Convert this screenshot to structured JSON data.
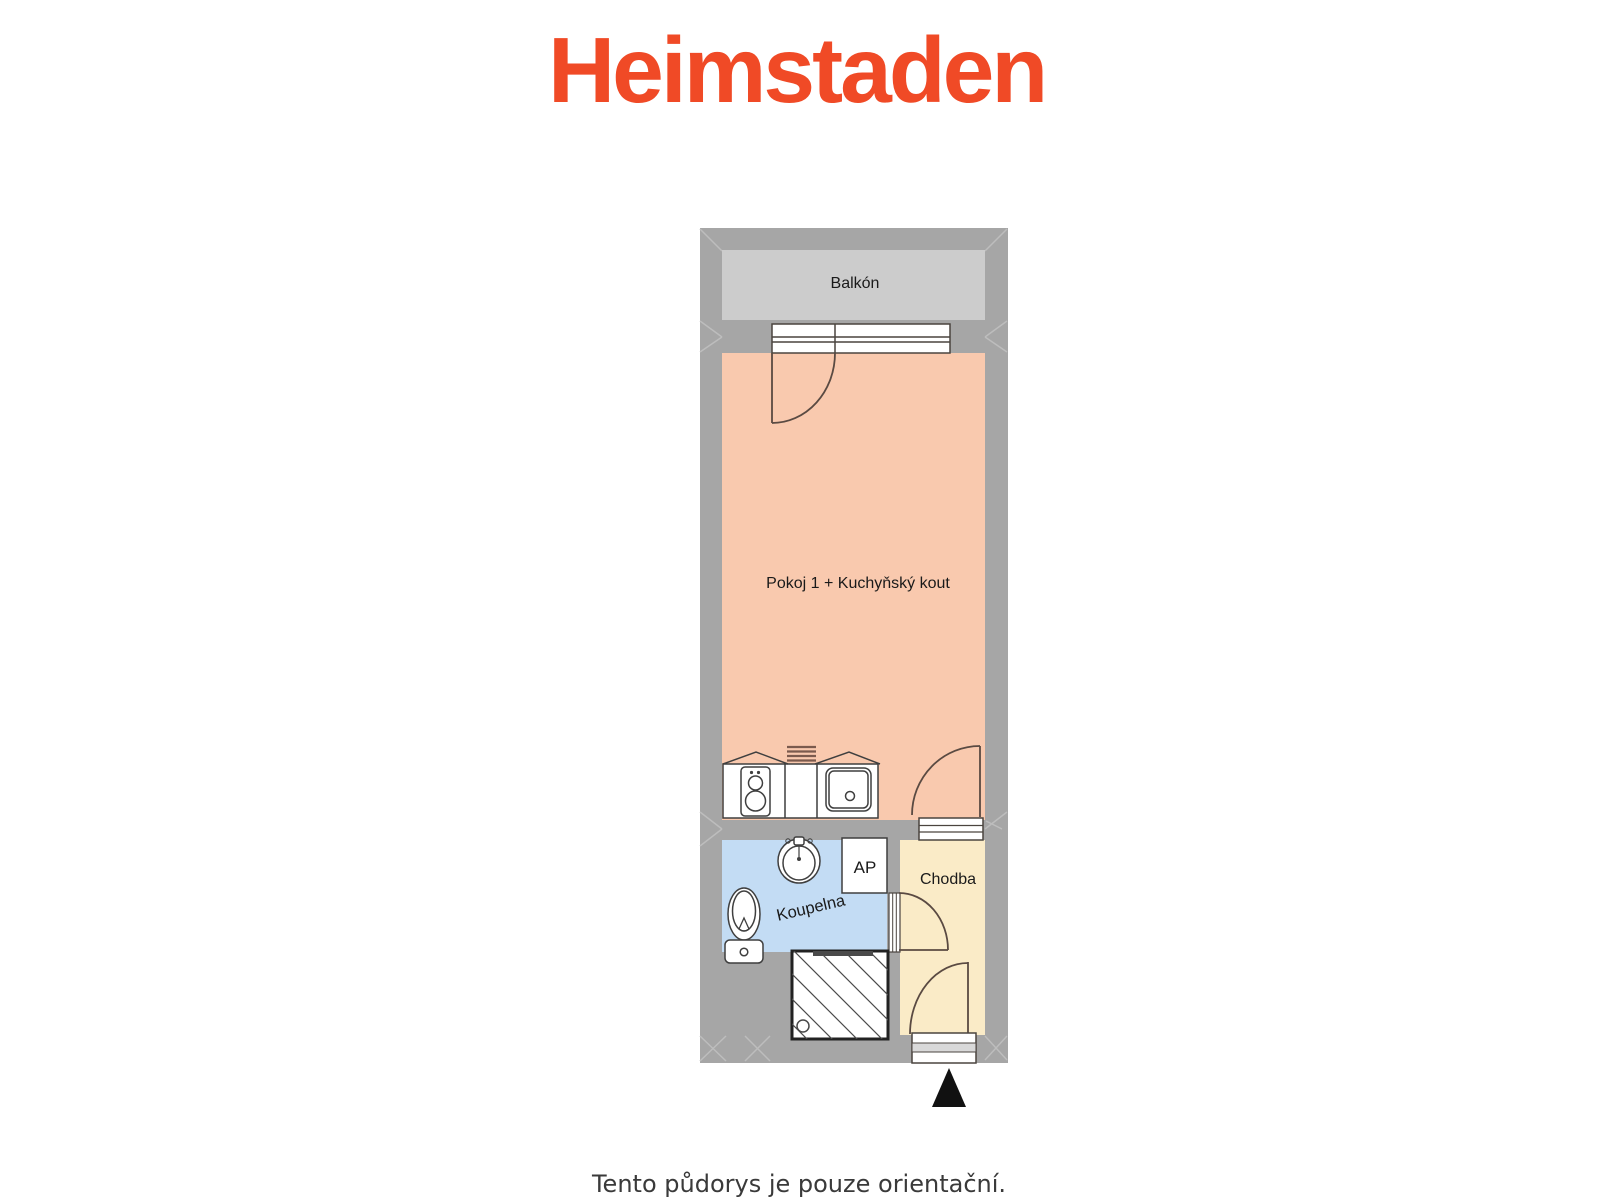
{
  "header": {
    "logo": "Heimstaden",
    "logo_color": "#f04a26"
  },
  "floorplan": {
    "wall_color": "#a6a6a6",
    "rooms": {
      "balkon": {
        "label": "Balkón",
        "color": "#cccccc"
      },
      "pokoj": {
        "label": "Pokoj 1 + Kuchyňský kout",
        "color": "#f9c9ae"
      },
      "koupelna": {
        "label": "Koupelna",
        "color": "#c3dcf4"
      },
      "ap": {
        "label": "AP",
        "color": "#ffffff"
      },
      "chodba": {
        "label": "Chodba",
        "color": "#faebc7"
      }
    },
    "fixtures": [
      "balcony-window",
      "balcony-door",
      "washing-machine",
      "kitchen-counter",
      "kitchen-sink",
      "radiator",
      "room-door",
      "washbasin",
      "toilet",
      "bathroom-door",
      "shower",
      "entrance-door",
      "entrance-threshold",
      "entrance-arrow"
    ],
    "arrow_color": "#111111"
  },
  "footer": {
    "disclaimer": "Tento půdorys je pouze orientační."
  }
}
